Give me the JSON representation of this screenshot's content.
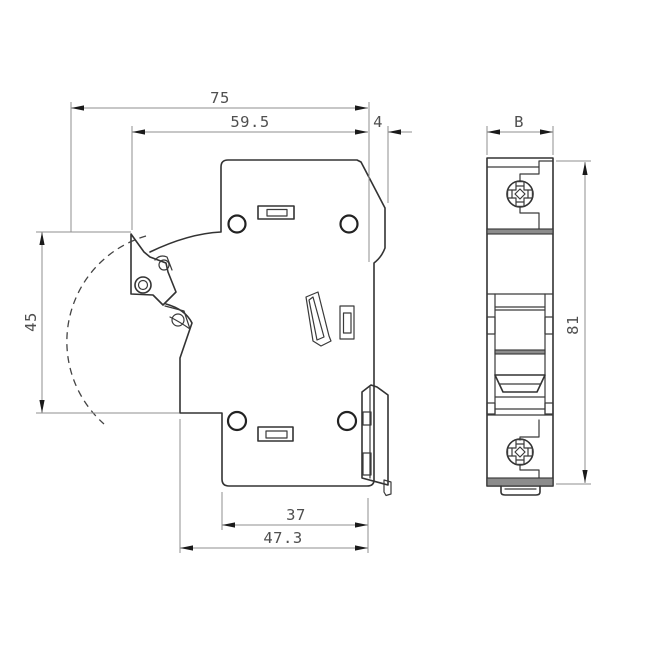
{
  "drawing": {
    "background": "#ffffff",
    "colors": {
      "outline": "#333333",
      "dimension_line": "#8f8f8f",
      "arrow": "#1a1a1a",
      "label_text": "#4f4f4f",
      "band_fill": "#8c8c8c"
    },
    "dimensions": {
      "total_depth": "75",
      "body_depth": "59.5",
      "rail_hook_depth": "4",
      "module_width": "B",
      "front_height": "45",
      "total_height": "81",
      "lower_depth_inner": "37",
      "lower_depth_outer": "47.3"
    }
  }
}
